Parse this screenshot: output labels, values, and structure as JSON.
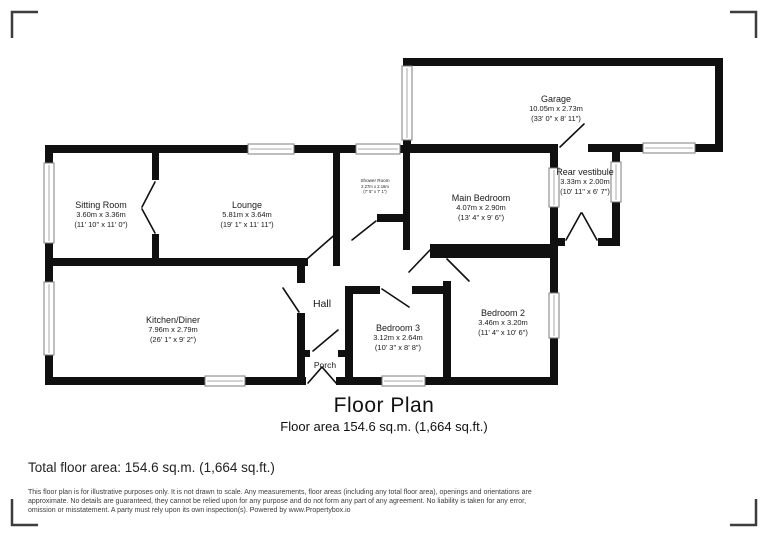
{
  "plan": {
    "title": "Floor Plan",
    "subtitle": "Floor area 154.6 sq.m. (1,664 sq.ft.)",
    "rooms": {
      "sitting_room": {
        "name": "Sitting Room",
        "metric": "3.60m x 3.36m",
        "imperial": "(11' 10\" x 11' 0\")"
      },
      "lounge": {
        "name": "Lounge",
        "metric": "5.81m x 3.64m",
        "imperial": "(19' 1\" x 11' 11\")"
      },
      "shower_room": {
        "name": "Shower Room",
        "metric": "2.27m x 2.16m",
        "imperial": "(7' 5\" x 7' 1\")"
      },
      "main_bedroom": {
        "name": "Main Bedroom",
        "metric": "4.07m x 2.90m",
        "imperial": "(13' 4\" x 9' 6\")"
      },
      "rear_vestibule": {
        "name": "Rear vestibule",
        "metric": "3.33m x 2.00m",
        "imperial": "(10' 11\" x 6' 7\")"
      },
      "garage": {
        "name": "Garage",
        "metric": "10.05m x 2.73m",
        "imperial": "(33' 0\" x 8' 11\")"
      },
      "kitchen_diner": {
        "name": "Kitchen/Diner",
        "metric": "7.96m x 2.79m",
        "imperial": "(26' 1\" x 9' 2\")"
      },
      "hall": {
        "name": "Hall"
      },
      "porch": {
        "name": "Porch"
      },
      "bedroom_3": {
        "name": "Bedroom 3",
        "metric": "3.12m x 2.64m",
        "imperial": "(10' 3\" x 8' 8\")"
      },
      "bedroom_2": {
        "name": "Bedroom 2",
        "metric": "3.46m x 3.20m",
        "imperial": "(11' 4\" x 10' 6\")"
      }
    }
  },
  "footer": {
    "total_area": "Total floor area: 154.6 sq.m. (1,664 sq.ft.)",
    "disclaimer_line1": "This floor plan is for illustrative purposes only. It is not drawn to scale. Any measurements, floor areas (including any total floor area), openings and orientations are",
    "disclaimer_line2": "approximate. No details are guaranteed, they cannot be relied upon for any purpose and do not form any part of any agreement. No liability is taken for any error,",
    "disclaimer_line3": "omission or misstatement. A party must rely upon its own inspection(s). Powered by www.Propertybox.io"
  },
  "colors": {
    "wall": "#101010",
    "window_frame": "#7d7d7d",
    "corner_bracket": "#3d3d3d",
    "text": "#1a1a1a"
  }
}
